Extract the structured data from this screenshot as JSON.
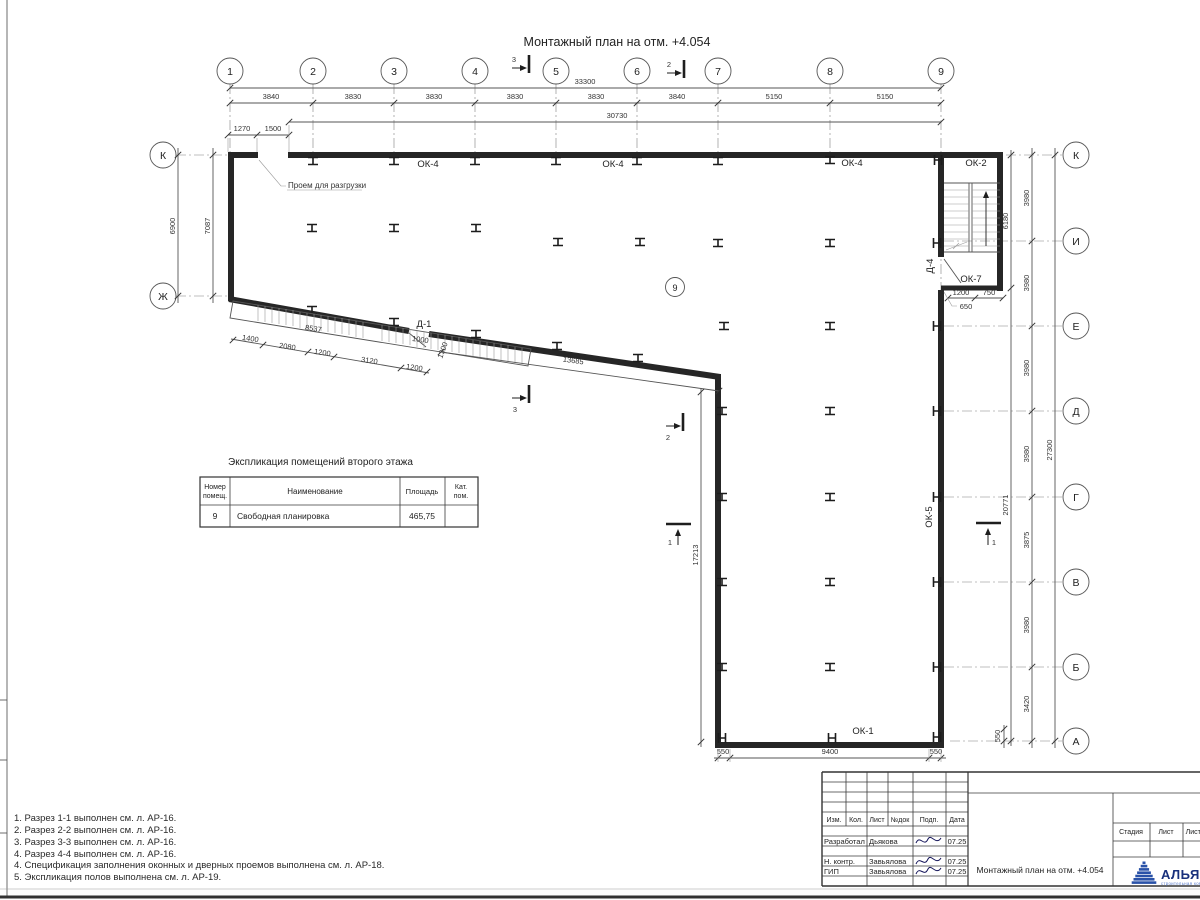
{
  "title": "Монтажный план на отм. +4.054",
  "grid": {
    "cols": [
      "1",
      "2",
      "3",
      "4",
      "5",
      "6",
      "7",
      "8",
      "9"
    ],
    "rows_right": [
      "К",
      "И",
      "Е",
      "Д",
      "Г",
      "В",
      "Б",
      "А"
    ],
    "rows_left": [
      "К",
      "Ж"
    ]
  },
  "dims": {
    "top_total": "33300",
    "top_segments": [
      "3840",
      "3830",
      "3830",
      "3830",
      "3830",
      "3840",
      "5150",
      "5150"
    ],
    "top_wall": "30730",
    "top_left": [
      "1270",
      "1500"
    ],
    "left_outer": "6900",
    "left_inner": "7087",
    "right_segments": [
      "3980",
      "3980",
      "3980",
      "3980",
      "3875",
      "3980",
      "3420"
    ],
    "right_total": "27300",
    "right_inner": "20771",
    "stair_height": "6180",
    "stair_bottom": [
      "1200",
      "750"
    ],
    "stair_leader": "650",
    "right_bottom_offset": "550",
    "bottom": [
      "550",
      "9400",
      "550"
    ],
    "ramp_length": "8537",
    "ramp_segments": [
      "1400",
      "2080",
      "1200",
      "3120",
      "1200"
    ],
    "door_width": "1000",
    "door_offset": "1300",
    "diagonal": "13685",
    "vertical": "17213"
  },
  "labels": {
    "windows": {
      "ok4a": "ОК-4",
      "ok4b": "ОК-4",
      "ok4c": "ОК-4",
      "ok2": "ОК-2",
      "ok7": "ОК-7",
      "ok5": "ОК-5",
      "ok1": "ОК-1"
    },
    "doors": {
      "d1": "Д-1",
      "d4": "Д-4"
    },
    "room_number": "9",
    "opening_note": "Проем для разгрузки"
  },
  "sections": {
    "s1": "1",
    "s2": "2",
    "s3": "3"
  },
  "table": {
    "title": "Экспликация помещений второго этажа",
    "header_num_l1": "Номер",
    "header_num_l2": "помещ.",
    "header_name": "Наименование",
    "header_area": "Площадь",
    "header_cat_l1": "Кат.",
    "header_cat_l2": "пом.",
    "row": {
      "num": "9",
      "name": "Свободная планировка",
      "area": "465,75",
      "cat": ""
    }
  },
  "notes": [
    "1. Разрез 1-1 выполнен см. л. АР-16.",
    "2. Разрез 2-2 выполнен см. л. АР-16.",
    "3. Разрез 3-3 выполнен см. л. АР-16.",
    "4. Разрез 4-4 выполнен см. л. АР-16.",
    "4. Спецификация заполнения оконных и дверных проемов выполнена см. л. АР-18.",
    "5. Экспликация полов выполнена см. л. АР-19."
  ],
  "titleblock": {
    "cols": [
      "Изм.",
      "Кол.",
      "Лист",
      "№док",
      "Подп.",
      "Дата"
    ],
    "rows": [
      {
        "role": "Разработал",
        "name": "Дьякова",
        "date": "07.25"
      },
      {
        "role": "Н. контр.",
        "name": "Завьялова",
        "date": "07.25"
      },
      {
        "role": "ГИП",
        "name": "Завьялова",
        "date": "07.25"
      }
    ],
    "doc_title": "Монтажный план на отм. +4.054",
    "stage_cols": [
      "Стадия",
      "Лист",
      "Листов"
    ],
    "company_name": "АЛЬЯНС",
    "company_sub": "строительная компания",
    "brand_color": "#2a52a8"
  }
}
